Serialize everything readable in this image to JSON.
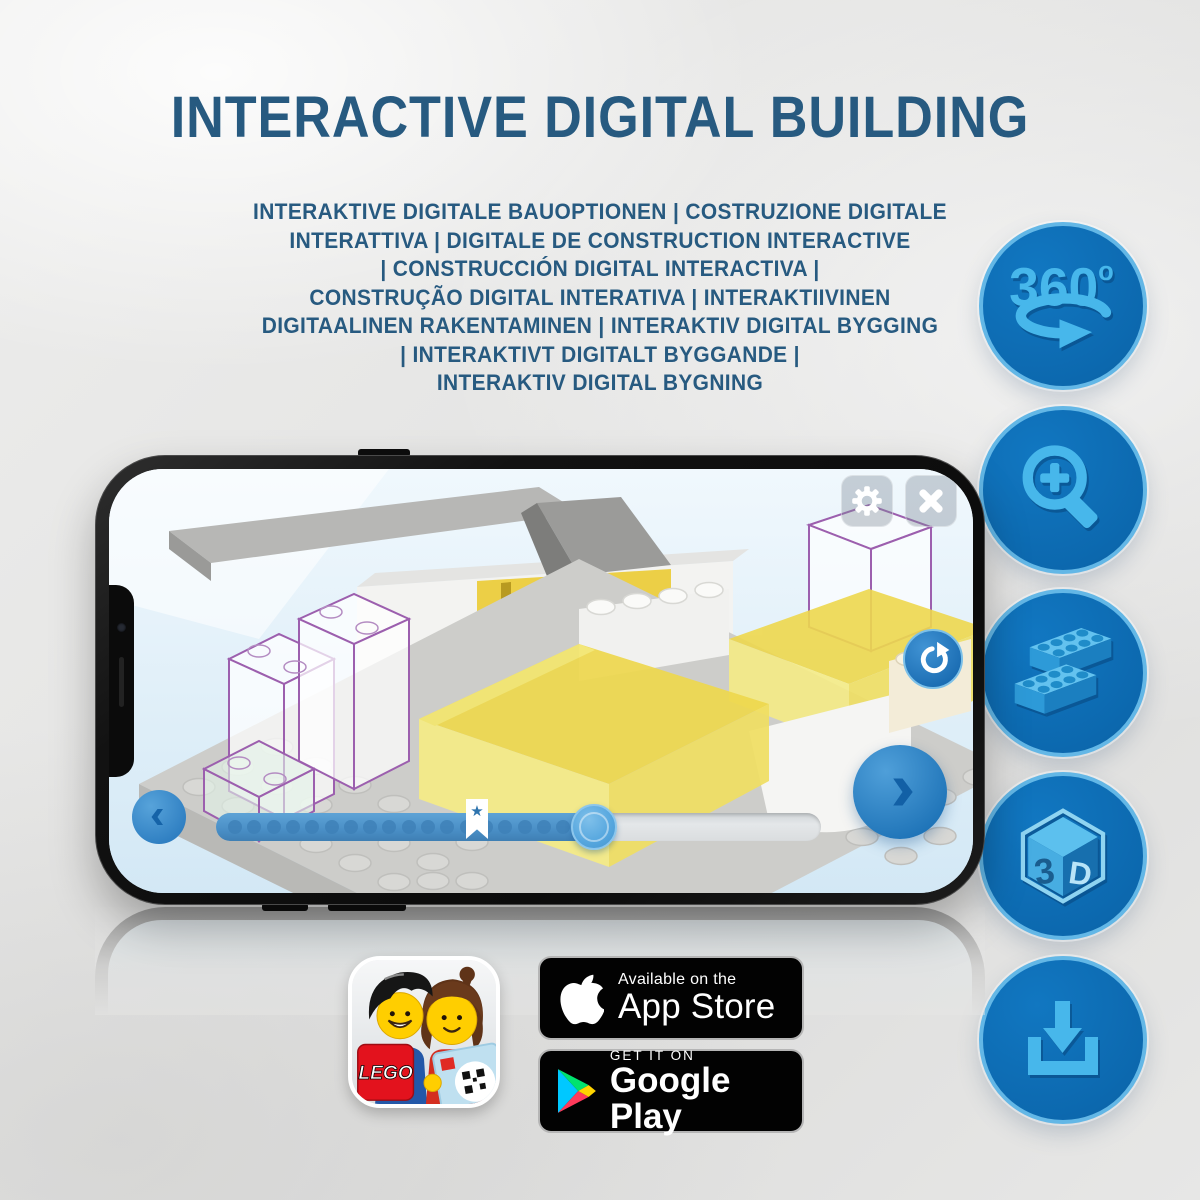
{
  "title": "INTERACTIVE DIGITAL BUILDING",
  "subtitle": {
    "lines": [
      "INTERAKTIVE DIGITALE BAUOPTIONEN | COSTRUZIONE DIGITALE",
      "INTERATTIVA | DIGITALE DE CONSTRUCTION INTERACTIVE",
      "| CONSTRUCCIÓN DIGITAL INTERACTIVA |",
      "CONSTRUÇÃO DIGITAL INTERATIVA | INTERAKTIIVINEN",
      "DIGITAALINEN RAKENTAMINEN | INTERAKTIV DIGITAL BYGGING",
      "| INTERAKTIVT DIGITALT BYGGANDE |",
      "INTERAKTIV DIGITAL BYGNING"
    ]
  },
  "feature_panel": {
    "items": [
      {
        "id": "rotate-360",
        "label": "360",
        "degree_symbol": "o"
      },
      {
        "id": "zoom-in"
      },
      {
        "id": "brick-building"
      },
      {
        "id": "view-3d",
        "left_glyph": "3",
        "right_glyph": "D"
      },
      {
        "id": "download"
      }
    ]
  },
  "phone_ui": {
    "star_marker_glyph": "★"
  },
  "store": {
    "app_store": {
      "tagline": "Available on the",
      "name": "App Store"
    },
    "google_play": {
      "tagline": "GET IT ON",
      "name": "Google Play"
    },
    "lego_app_icon": {
      "logo_text": "LEGO"
    }
  },
  "colors": {
    "heading_text": "#275a80",
    "feature_circle_fill": "#0c68ae",
    "feature_circle_border": "#63b7e6",
    "feature_icon_blue": "#47b7eb",
    "screen_background": "#dceef9",
    "highlight_brick_yellow": "#eed84e",
    "ghost_outline_purple": "#9c5fae",
    "progress_fill_blue": "#4a8fc6",
    "slider_knob_blue": "#55a6de",
    "badge_background": "#020202"
  }
}
